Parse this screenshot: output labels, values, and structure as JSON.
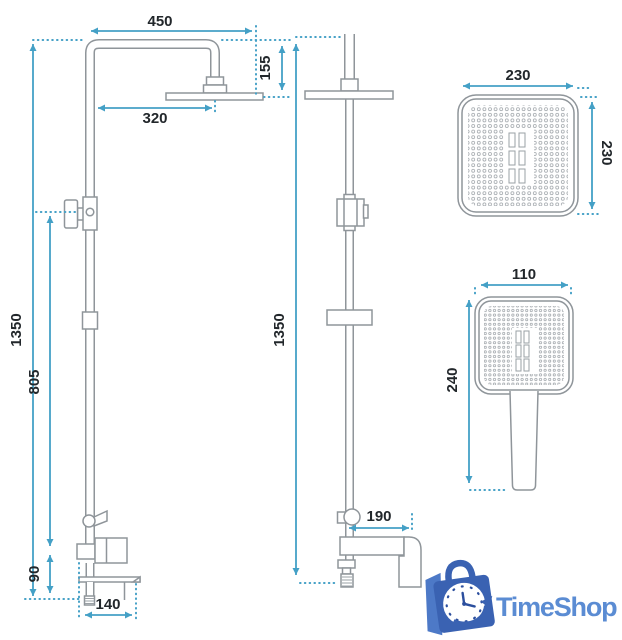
{
  "dims": {
    "front": {
      "top_width": "450",
      "head_height": "155",
      "head_reach": "320",
      "total_height": "1350",
      "riser_height": "805",
      "mixer_height": "90",
      "base_width": "140"
    },
    "side": {
      "total_height": "1350",
      "spout_reach": "190"
    },
    "overhead": {
      "width": "230",
      "depth": "230"
    },
    "handshower": {
      "width": "110",
      "length": "240"
    }
  },
  "logo": {
    "text": "TimeShop"
  },
  "colors": {
    "dimension_line": "#44a0c6",
    "drawing_outline": "#8f959a",
    "label_text": "#22272b",
    "logo_bag": "#3a62b2",
    "logo_text": "#5b8cd3"
  }
}
